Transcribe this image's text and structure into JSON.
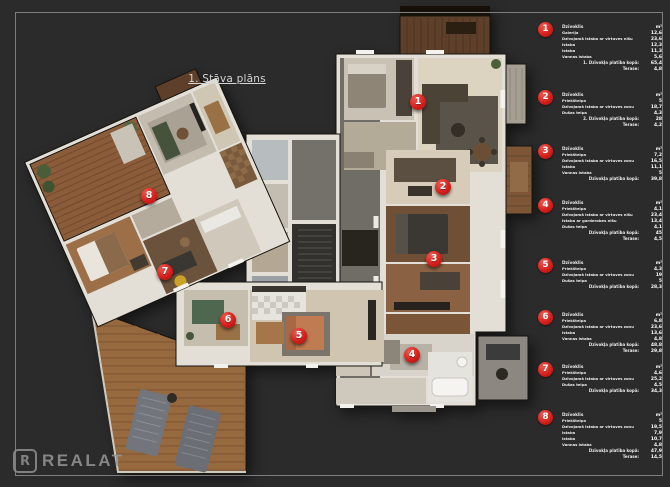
{
  "page": {
    "background": "#2b2b2b",
    "frame_color": "#7d7d7d"
  },
  "title": "1. Stāva plāns",
  "logo": {
    "icon_letter": "R",
    "text": "REALAT"
  },
  "colors": {
    "marker_red": "#d7201c",
    "wall": "#e3dfd7",
    "deck_wood": "#96693f"
  },
  "plan": {
    "markers": [
      {
        "label": "1",
        "x": 418,
        "y": 102
      },
      {
        "label": "2",
        "x": 443,
        "y": 187
      },
      {
        "label": "3",
        "x": 434,
        "y": 259
      },
      {
        "label": "4",
        "x": 412,
        "y": 355
      },
      {
        "label": "5",
        "x": 299,
        "y": 336
      },
      {
        "label": "6",
        "x": 228,
        "y": 320
      },
      {
        "label": "7",
        "x": 165,
        "y": 272
      },
      {
        "label": "8",
        "x": 149,
        "y": 196
      }
    ]
  },
  "legend": {
    "header_label": "Dzīvoklis",
    "unit_label": "m²",
    "items": [
      {
        "number": "1",
        "top": 24,
        "rooms": [
          [
            "Galerija",
            "12,6"
          ],
          [
            "Dzīvojamā istaba ar virtuves nišu",
            "23,6"
          ],
          [
            "Istaba",
            "12,3"
          ],
          [
            "Istaba",
            "11,3"
          ],
          [
            "Vannas istaba",
            "5,6"
          ]
        ],
        "total": [
          "1. Dzīvokļa platība kopā:",
          "65,4"
        ],
        "terrace": [
          "Terase:",
          "4,8"
        ]
      },
      {
        "number": "2",
        "top": 92,
        "rooms": [
          [
            "Priekštelpa",
            "5"
          ],
          [
            "Dzīvojamā istaba ar virtuves zonu",
            "18,7"
          ],
          [
            "Dušas telpa",
            "4,3"
          ]
        ],
        "total": [
          "2. Dzīvokļa platība kopā:",
          "28"
        ],
        "terrace": [
          "Terase:",
          "4,2"
        ]
      },
      {
        "number": "3",
        "top": 146,
        "rooms": [
          [
            "Priekštelpa",
            "7,2"
          ],
          [
            "Dzīvojamā istaba ar virtuves zonu",
            "16,5"
          ],
          [
            "Istaba",
            "11,1"
          ],
          [
            "Vannas istaba",
            "5"
          ]
        ],
        "total": [
          "Dzīvokļa platība kopā:",
          "39,8"
        ]
      },
      {
        "number": "4",
        "top": 200,
        "rooms": [
          [
            "Priekštelpa",
            "4,1"
          ],
          [
            "Dzīvojamā istaba ar virtuves nišu",
            "23,4"
          ],
          [
            "Istaba ar garderobes nišu",
            "13,4"
          ],
          [
            "Dušas telpa",
            "4,1"
          ]
        ],
        "total": [
          "Dzīvokļa platība kopā:",
          "45"
        ],
        "terrace": [
          "Terase:",
          "4,5"
        ]
      },
      {
        "number": "5",
        "top": 260,
        "rooms": [
          [
            "Priekštelpa",
            "4,3"
          ],
          [
            "Dzīvojamā istaba ar virtuves zonu",
            "19"
          ],
          [
            "Dušas telpa",
            "5"
          ]
        ],
        "total": [
          "Dzīvokļa platība kopā:",
          "28,3"
        ]
      },
      {
        "number": "6",
        "top": 312,
        "rooms": [
          [
            "Priekštelpa",
            "6,8"
          ],
          [
            "Dzīvojamā istaba ar virtuves zonu",
            "23,6"
          ],
          [
            "Istaba",
            "13,6"
          ],
          [
            "Vannas istaba",
            "4,8"
          ]
        ],
        "total": [
          "Dzīvokļa platība kopā:",
          "48,8"
        ],
        "terrace": [
          "Terase:",
          "29,8"
        ]
      },
      {
        "number": "7",
        "top": 364,
        "rooms": [
          [
            "Priekštelpa",
            "4,6"
          ],
          [
            "Dzīvojamā istaba ar virtuves zonu",
            "25,2"
          ],
          [
            "Dušas telpa",
            "4,5"
          ]
        ],
        "total": [
          "Dzīvokļa platība kopā:",
          "34,3"
        ]
      },
      {
        "number": "8",
        "top": 412,
        "rooms": [
          [
            "Priekštelpa",
            "5"
          ],
          [
            "Dzīvojamā istaba ar virtuves zonu",
            "19,5"
          ],
          [
            "Istaba",
            "7,9"
          ],
          [
            "Istaba",
            "10,7"
          ],
          [
            "Vannas istaba",
            "4,8"
          ]
        ],
        "total": [
          "Dzīvokļa platība kopā:",
          "47,9"
        ],
        "terrace": [
          "Terase:",
          "14,5"
        ]
      }
    ]
  }
}
